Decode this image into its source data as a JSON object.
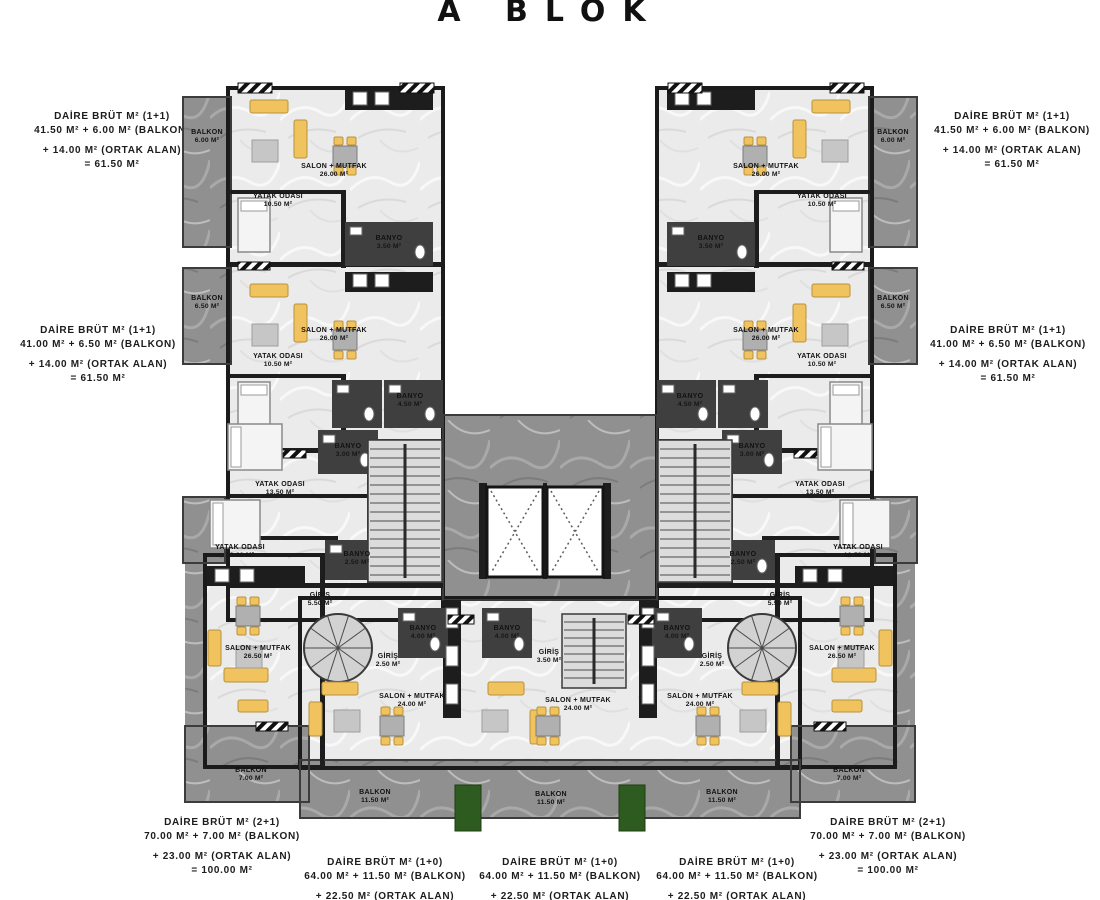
{
  "title": "A BLOK",
  "summaries": {
    "top_left": {
      "line1": "DAİRE BRÜT M² (1+1)",
      "line2": "41.50 M² + 6.00 M² (BALKON)",
      "line3": "+ 14.00 M² (ORTAK ALAN)",
      "line4": "= 61.50 M²"
    },
    "top_right": {
      "line1": "DAİRE BRÜT M² (1+1)",
      "line2": "41.50 M² + 6.00 M² (BALKON)",
      "line3": "+ 14.00 M² (ORTAK ALAN)",
      "line4": "= 61.50 M²"
    },
    "mid_left": {
      "line1": "DAİRE BRÜT M² (1+1)",
      "line2": "41.00 M² + 6.50 M² (BALKON)",
      "line3": "+ 14.00 M² (ORTAK ALAN)",
      "line4": "= 61.50 M²"
    },
    "mid_right": {
      "line1": "DAİRE BRÜT M² (1+1)",
      "line2": "41.00 M² + 6.50 M² (BALKON)",
      "line3": "+ 14.00 M² (ORTAK ALAN)",
      "line4": "= 61.50 M²"
    },
    "bottom_left": {
      "line1": "DAİRE BRÜT M² (2+1)",
      "line2": "70.00 M² + 7.00 M² (BALKON)",
      "line3": "+ 23.00 M² (ORTAK ALAN)",
      "line4": "= 100.00 M²"
    },
    "bottom_right": {
      "line1": "DAİRE BRÜT M² (2+1)",
      "line2": "70.00 M² + 7.00 M² (BALKON)",
      "line3": "+ 23.00 M² (ORTAK ALAN)",
      "line4": "= 100.00 M²"
    },
    "bottom_center_1": {
      "line1": "DAİRE BRÜT M² (1+0)",
      "line2": "64.00 M² + 11.50 M² (BALKON)",
      "line3": "+ 22.50 M² (ORTAK ALAN)",
      "line4": "=98.00 M²"
    },
    "bottom_center_2": {
      "line1": "DAİRE BRÜT M² (1+0)",
      "line2": "64.00 M² + 11.50 M² (BALKON)",
      "line3": "+ 22.50 M² (ORTAK ALAN)",
      "line4": "=98.00 M²"
    },
    "bottom_center_3": {
      "line1": "DAİRE BRÜT M² (1+0)",
      "line2": "64.00 M² + 11.50 M² (BALKON)",
      "line3": "+ 22.50 M² (ORTAK ALAN)",
      "line4": "=98.00 M²"
    }
  },
  "rooms": {
    "balkon_a1": {
      "name": "BALKON",
      "area": "6.00 M²"
    },
    "salon_a1": {
      "name": "SALON + MUTFAK",
      "area": "26.00 M²"
    },
    "yatak_a1": {
      "name": "YATAK ODASI",
      "area": "10.50 M²"
    },
    "banyo_a1": {
      "name": "BANYO",
      "area": "3.50 M²"
    },
    "balkon_a2": {
      "name": "BALKON",
      "area": "6.50 M²"
    },
    "salon_a2": {
      "name": "SALON + MUTFAK",
      "area": "26.00 M²"
    },
    "yatak_a2": {
      "name": "YATAK ODASI",
      "area": "10.50 M²"
    },
    "banyo_a2": {
      "name": "BANYO",
      "area": "4.50 M²"
    },
    "banyo_a3": {
      "name": "BANYO",
      "area": "3.00 M²"
    },
    "yatak_a3": {
      "name": "YATAK ODASI",
      "area": "13.50 M²"
    },
    "yatak_a4": {
      "name": "YATAK ODASI",
      "area": "10.00 M²"
    },
    "banyo_a4": {
      "name": "BANYO",
      "area": "2.50 M²"
    },
    "giris_a": {
      "name": "GİRİŞ",
      "area": "5.50 M²"
    },
    "salon_a5": {
      "name": "SALON + MUTFAK",
      "area": "26.50 M²"
    },
    "balkon_a5": {
      "name": "BALKON",
      "area": "7.00 M²"
    },
    "balkon_b1": {
      "name": "BALKON",
      "area": "6.00 M²"
    },
    "salon_b1": {
      "name": "SALON + MUTFAK",
      "area": "26.00 M²"
    },
    "yatak_b1": {
      "name": "YATAK ODASI",
      "area": "10.50 M²"
    },
    "banyo_b1": {
      "name": "BANYO",
      "area": "3.50 M²"
    },
    "balkon_b2": {
      "name": "BALKON",
      "area": "6.50 M²"
    },
    "salon_b2": {
      "name": "SALON + MUTFAK",
      "area": "26.00 M²"
    },
    "yatak_b2": {
      "name": "YATAK ODASI",
      "area": "10.50 M²"
    },
    "banyo_b2": {
      "name": "BANYO",
      "area": "4.50 M²"
    },
    "banyo_b3": {
      "name": "BANYO",
      "area": "3.00 M²"
    },
    "yatak_b3": {
      "name": "YATAK ODASI",
      "area": "13.50 M²"
    },
    "yatak_b4": {
      "name": "YATAK ODASI",
      "area": "10.50 M²"
    },
    "banyo_b4": {
      "name": "BANYO",
      "area": "2.50 M²"
    },
    "giris_b": {
      "name": "GİRİŞ",
      "area": "5.50 M²"
    },
    "salon_b5": {
      "name": "SALON + MUTFAK",
      "area": "26.50 M²"
    },
    "balkon_b5": {
      "name": "BALKON",
      "area": "7.00 M²"
    },
    "giris_c1": {
      "name": "GİRİŞ",
      "area": "2.50 M²"
    },
    "banyo_c1": {
      "name": "BANYO",
      "area": "4.00 M²"
    },
    "banyo_c2": {
      "name": "BANYO",
      "area": "4.00 M²"
    },
    "giris_c2": {
      "name": "GİRİŞ",
      "area": "3.50 M²"
    },
    "banyo_c3": {
      "name": "BANYO",
      "area": "4.00 M²"
    },
    "giris_c3": {
      "name": "GİRİŞ",
      "area": "2.50 M²"
    },
    "salon_c1": {
      "name": "SALON + MUTFAK",
      "area": "24.00 M²"
    },
    "salon_c2": {
      "name": "SALON + MUTFAK",
      "area": "24.00 M²"
    },
    "salon_c3": {
      "name": "SALON + MUTFAK",
      "area": "24.00 M²"
    },
    "balkon_c1": {
      "name": "BALKON",
      "area": "11.50 M²"
    },
    "balkon_c2": {
      "name": "BALKON",
      "area": "11.50 M²"
    },
    "balkon_c3": {
      "name": "BALKON",
      "area": "11.50 M²"
    }
  },
  "colors": {
    "wall": "#1b1b1b",
    "marble_dark": "#909090",
    "marble_light": "#ebebeb",
    "furniture": "#f0c35f",
    "plant": "#2e5c20"
  }
}
